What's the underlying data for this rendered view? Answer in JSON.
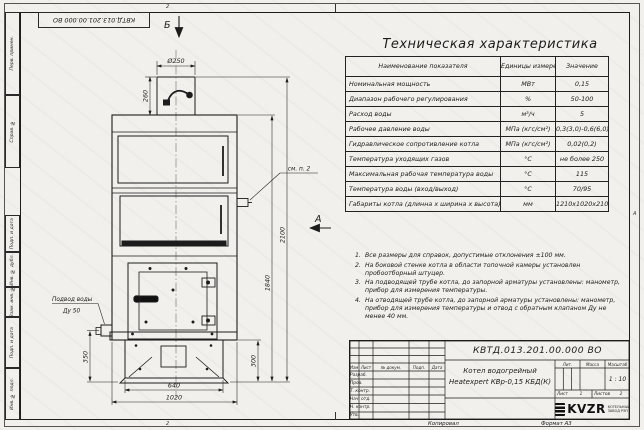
{
  "sheet": {
    "corner_number": "КВТД.013.201.00.000 ВО",
    "zone_marker_top": "2",
    "zone_marker_bottom": "2",
    "zone_marker_right": "А",
    "side_labels": [
      {
        "label": "Перв. примен."
      },
      {
        "label": "Справ. №"
      },
      {
        "label": "Подп. и дата"
      },
      {
        "label": "Инв. № дубл."
      },
      {
        "label": "Взам. инв. №"
      },
      {
        "label": "Подп. и дата"
      },
      {
        "label": "Инв. № подл."
      }
    ],
    "copy_label": "Копировал",
    "format_label": "Формат А3"
  },
  "drawing": {
    "view_arrow_b": "Б",
    "view_arrow_a": "А",
    "callout_note2": "см. п. 2",
    "water_inlet_line1": "Подвод воды",
    "water_inlet_line2": "Ду 50",
    "dims": {
      "chimney_diameter": "Ø250",
      "chimney_height": "260",
      "total_height": "2100",
      "body_height": "1840",
      "inlet_height": "350",
      "base_height": "300",
      "base_width": "640",
      "overall_width": "1020"
    }
  },
  "spec_table": {
    "title": "Техническая характеристика",
    "col_name": "Наименование показателя",
    "col_unit": "Единицы измерения",
    "col_value": "Значение",
    "rows": [
      {
        "name": "Номинальная мощность",
        "unit": "МВт",
        "value": "0,15"
      },
      {
        "name": "Диапазон рабочего регулирования",
        "unit": "%",
        "value": "50-100"
      },
      {
        "name": "Расход воды",
        "unit": "м³/ч",
        "value": "5"
      },
      {
        "name": "Рабочее давление воды",
        "unit": "МПа (кгс/см²)",
        "value": "0,3(3,0)-0,6(6,0)"
      },
      {
        "name": "Гидравлическое сопротивление котла",
        "unit": "МПа (кгс/см²)",
        "value": "0,02(0,2)"
      },
      {
        "name": "Температура уходящих газов",
        "unit": "°С",
        "value": "не более 250"
      },
      {
        "name": "Максимальная рабочая температура воды",
        "unit": "°С",
        "value": "115"
      },
      {
        "name": "Температура воды (вход/выход)",
        "unit": "°С",
        "value": "70/95"
      },
      {
        "name": "Габариты котла (длинна х ширина х высота)",
        "unit": "мм",
        "value": "1210х1020х2100"
      }
    ]
  },
  "notes": [
    {
      "num": "1.",
      "text": "Все размеры для справок, допустимые отклонения ±100 мм."
    },
    {
      "num": "2.",
      "text": "На боковой стенке котла в области топочной камеры установлен пробоотборный штуцер."
    },
    {
      "num": "3.",
      "text": "На подводящей трубе котла, до запорной арматуры установлены: манометр, прибор для измерения температуры."
    },
    {
      "num": "4.",
      "text": "На отводящей трубе котла, до запорной арматуры установлены: манометр, прибор для измерения температуры и отвод с обратным клапаном Ду не менее 40 мм."
    }
  ],
  "title_block": {
    "doc_number": "КВТД.013.201.00.000 ВО",
    "product_line1": "Котел водогрейный",
    "product_line2": "Heatexpert КВр-0,15 КБД(К)",
    "cols": {
      "izm": "Изм",
      "list": "Лист",
      "doc": "№ докум.",
      "podp": "Подп.",
      "data": "Дата"
    },
    "row_labels": [
      {
        "label": "Разраб."
      },
      {
        "label": "Пров."
      },
      {
        "label": "Т. контр."
      },
      {
        "label": "Нач. отд."
      },
      {
        "label": "Н. контр."
      },
      {
        "label": "Утв."
      }
    ],
    "lit_label": "Лит.",
    "mass_label": "Масса",
    "scale_label": "Масштаб",
    "scale_value": "1 : 10",
    "sheet_label": "Лист",
    "sheet_value": "1",
    "sheets_label": "Листов",
    "sheets_value": "2",
    "logo_text": "KVZR",
    "logo_sub1": "КОТЕЛЬНЫЙ",
    "logo_sub2": "ЗАВОД  РЭП"
  }
}
